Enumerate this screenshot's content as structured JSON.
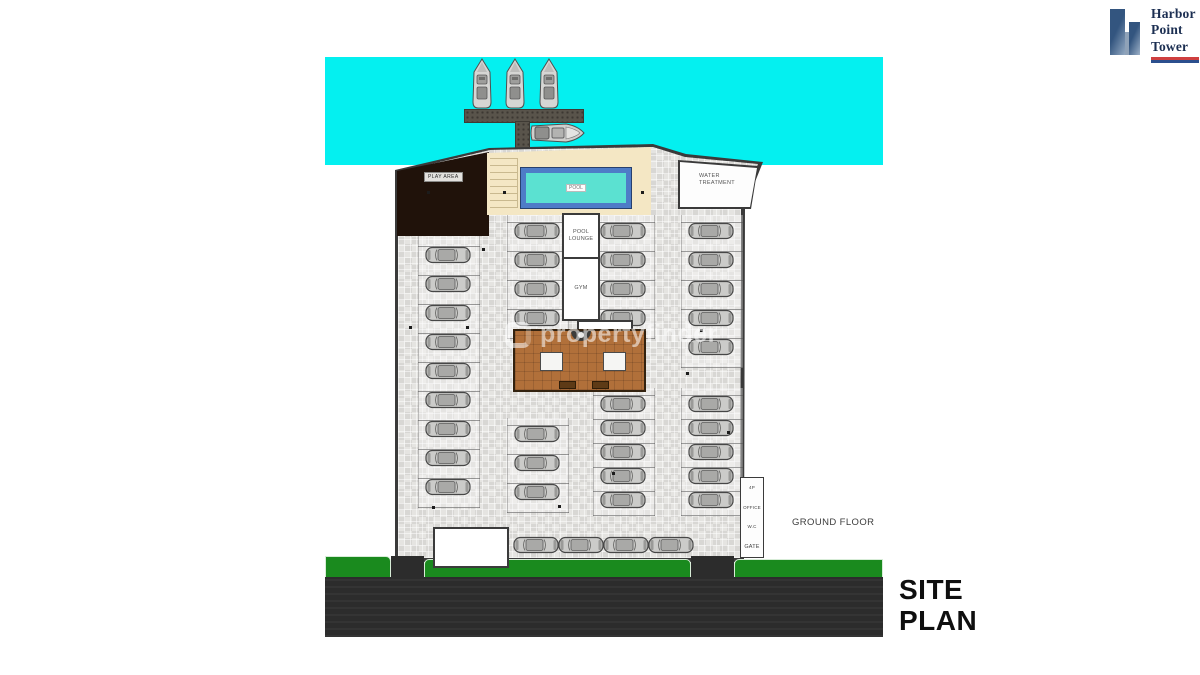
{
  "brand": {
    "lines": [
      "Harbor",
      "Point",
      "Tower"
    ],
    "accent_red": "#cf3f3f",
    "accent_blue": "#2b4f8e",
    "navy": "#1c2f52"
  },
  "titles": {
    "site_plan_line1": "SITE",
    "site_plan_line2": "PLAN",
    "ground_floor": "GROUND FLOOR"
  },
  "watermark": {
    "text": "propertyfinder"
  },
  "plan": {
    "labels": {
      "play_area": "PLAY AREA",
      "pool": "POOL",
      "water_treatment": "WATER TREATMENT",
      "pool_lounge": "POOL LOUNGE",
      "gym": "GYM"
    },
    "gate_strip": [
      "4P",
      "OFFICE",
      "W.C",
      "GATE"
    ],
    "structure_dots": [
      [
        427,
        191
      ],
      [
        503,
        191
      ],
      [
        641,
        191
      ],
      [
        482,
        248
      ],
      [
        409,
        326
      ],
      [
        466,
        326
      ],
      [
        523,
        372
      ],
      [
        641,
        371
      ],
      [
        700,
        329
      ],
      [
        432,
        506
      ],
      [
        558,
        505
      ],
      [
        612,
        472
      ],
      [
        727,
        431
      ],
      [
        686,
        372
      ]
    ]
  },
  "colors": {
    "water": "#04f0f0",
    "grass": "#1a8a1e",
    "road": "#2c2c2c",
    "lobby_wood": "#b1703a",
    "pool_water": "#5be1d1",
    "pool_tile": "#4e7cc7",
    "play_area": "#20120a",
    "pool_deck": "#f4e7c4"
  },
  "parking": {
    "columns": [
      {
        "x": 425,
        "y": 216,
        "count": 10,
        "gap": 29
      },
      {
        "x": 514,
        "y": 221,
        "count": 4,
        "gap": 29
      },
      {
        "x": 514,
        "y": 424,
        "count": 3,
        "gap": 29
      },
      {
        "x": 600,
        "y": 221,
        "count": 4,
        "gap": 29
      },
      {
        "x": 600,
        "y": 394,
        "count": 5,
        "gap": 24
      },
      {
        "x": 688,
        "y": 221,
        "count": 5,
        "gap": 29
      },
      {
        "x": 688,
        "y": 394,
        "count": 5,
        "gap": 24
      }
    ],
    "bottom_row": [
      {
        "x": 513,
        "y": 535
      },
      {
        "x": 558,
        "y": 535
      },
      {
        "x": 603,
        "y": 535
      },
      {
        "x": 648,
        "y": 535
      }
    ]
  },
  "marina": {
    "yacht_xs": [
      471,
      504,
      538
    ],
    "yacht_y": 58,
    "boat": {
      "x": 530,
      "y": 121
    }
  }
}
